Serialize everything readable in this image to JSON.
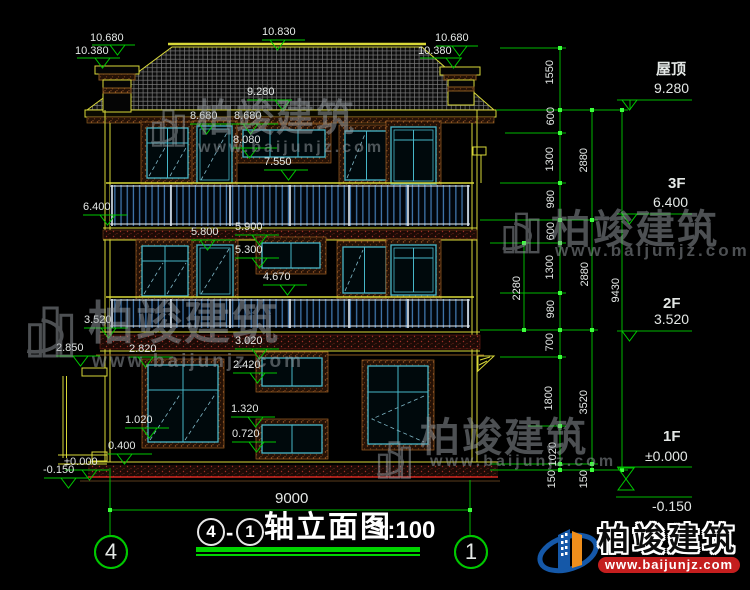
{
  "marks": {
    "m10680L": "10.680",
    "m10380L": "10.380",
    "m10830": "10.830",
    "m10680R": "10.680",
    "m10380R": "10.380",
    "m9280": "9.280",
    "m8680a": "8.680",
    "m8680b": "8.680",
    "m8080": "8.080",
    "m7550": "7.550",
    "m6400": "6.400",
    "m5800": "5.800",
    "m5900": "5.900",
    "m5300": "5.300",
    "m4670": "4.670",
    "m3520": "3.520",
    "m2850": "2.850",
    "m2820": "2.820",
    "m3020": "3.020",
    "m2420": "2.420",
    "m1320": "1.320",
    "m1020": "1.020",
    "m0720": "0.720",
    "m0400": "0.400",
    "mzero": "±0.000",
    "mneg": "-0.150"
  },
  "right": {
    "floors": [
      {
        "label": "屋顶",
        "elev": "9.280"
      },
      {
        "label": "3F",
        "elev": "6.400"
      },
      {
        "label": "2F",
        "elev": "3.520"
      },
      {
        "label": "1F",
        "elev": "±0.000"
      }
    ],
    "below": "-0.150",
    "c1": [
      "1550",
      "600",
      "1300",
      "980",
      "600",
      "1300",
      "980",
      "700",
      "1800",
      "1020",
      "150"
    ],
    "c2": [
      "2880",
      "2880",
      "3520",
      "150"
    ],
    "total": "9430",
    "partial": "2280"
  },
  "bottom": {
    "overall": "9000",
    "grid_left": "4",
    "grid_right": "1"
  },
  "titleblock": {
    "circle_left": "4",
    "dash": "-",
    "circle_right": "1",
    "name": "轴立面图",
    "scale": "1:100"
  },
  "watermark": {
    "brand": "柏竣建筑",
    "url": "www.baijunjz.com"
  },
  "logo": {
    "brand": "柏竣建筑",
    "url": "www.baijunjz.com"
  },
  "colors": {
    "cad_yellow": "#d8d838",
    "dim_green": "#00c800",
    "frame_cyan": "#46b6c8",
    "rail_blue": "#3f74ab",
    "ground_red": "#d42820",
    "logo_blue": "#1558a8",
    "logo_orange": "#ef8e1b",
    "band_red": "#c41e1e"
  }
}
